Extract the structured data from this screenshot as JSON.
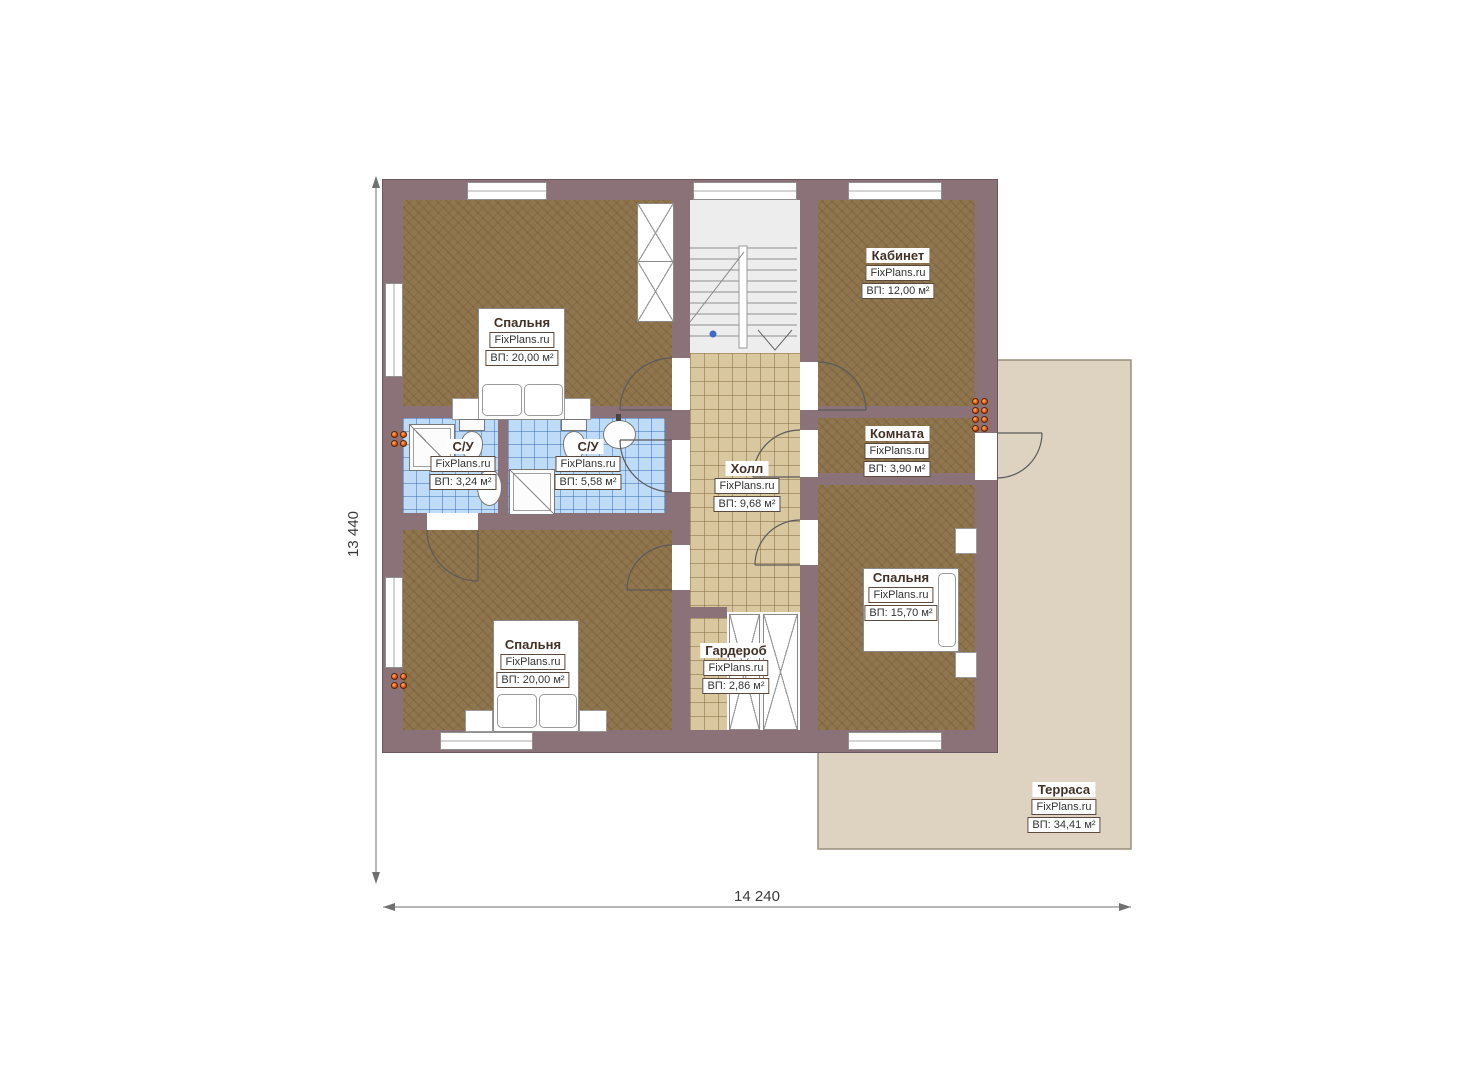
{
  "brand": "FixPlans.ru",
  "plan": {
    "dimension_width": "14 240",
    "dimension_height": "13 440"
  },
  "rooms": [
    {
      "name": "Спальня",
      "area": "ВП: 20,00 м²"
    },
    {
      "name": "Кабинет",
      "area": "ВП: 12,00 м²"
    },
    {
      "name": "С/У",
      "area": "ВП: 3,24 м²"
    },
    {
      "name": "С/У",
      "area": "ВП: 5,58 м²"
    },
    {
      "name": "Холл",
      "area": "ВП: 9,68 м²"
    },
    {
      "name": "Комната",
      "area": "ВП: 3,90 м²"
    },
    {
      "name": "Спальня",
      "area": "ВП: 20,00 м²"
    },
    {
      "name": "Гардероб",
      "area": "ВП: 2,86 м²"
    },
    {
      "name": "Спальня",
      "area": "ВП: 15,70 м²"
    },
    {
      "name": "Терраса",
      "area": "ВП: 34,41 м²"
    }
  ],
  "colors": {
    "wall": "#8b7279",
    "floor_wood": "#8f764e",
    "floor_tile": "#d8c79f",
    "floor_bath": "#bedcf7",
    "terrace": "#ddd3c0",
    "radiator": "#e05a14"
  }
}
